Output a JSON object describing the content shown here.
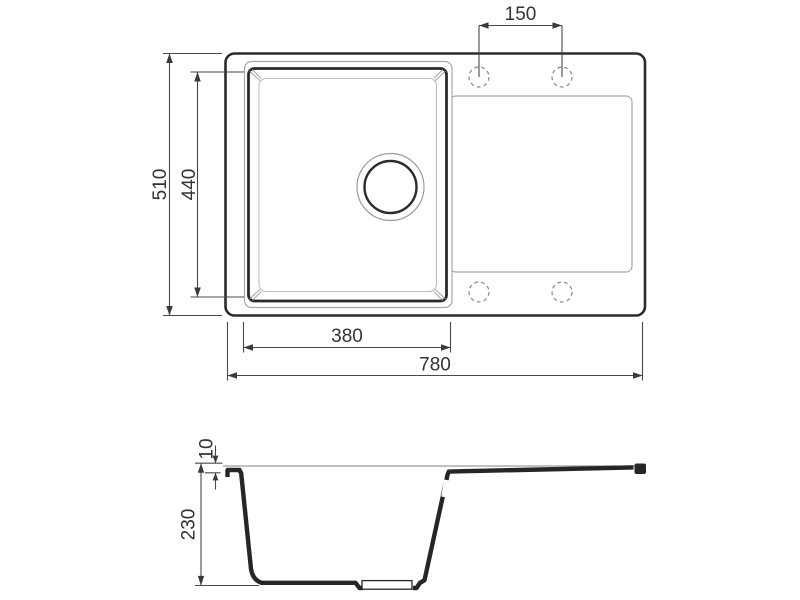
{
  "drawing": {
    "subject": "sink-dimension-drawing",
    "views": {
      "top_view": "top-view",
      "section_view": "section-view"
    },
    "dimensions": {
      "faucet_hole_spacing": "150",
      "overall_depth": "510",
      "bowl_inner_depth": "440",
      "bowl_width": "380",
      "overall_width": "780",
      "edge_thickness": "10",
      "bowl_depth": "230"
    },
    "colors": {
      "outline_dark": "#2b2b2b",
      "outline_thin": "#a8a8a8",
      "dimension_line": "#484848",
      "dimension_text": "#333333",
      "background": "#ffffff"
    }
  }
}
